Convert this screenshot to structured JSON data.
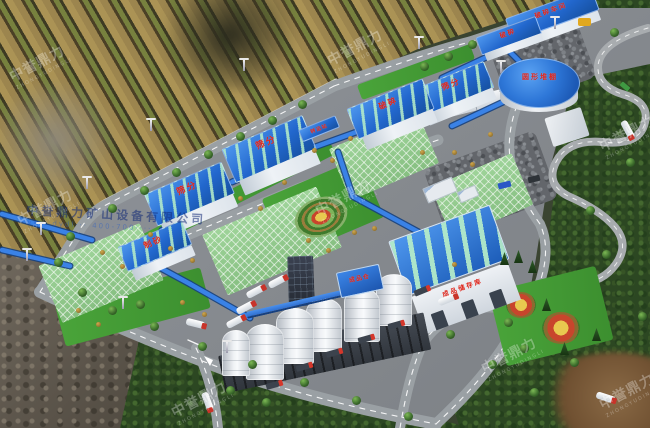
{
  "labels": {
    "crusher_station": "破碎车间",
    "crusher_top": "破碎",
    "screening_a": "筛分",
    "crusher_mid": "破碎",
    "screening_b": "筛分",
    "screening_c": "筛分",
    "sand_making": "制砂",
    "dome": "圆形堆棚",
    "transfer": "转运站",
    "warehouse_sign": "成品储存库",
    "silo_top_box": "成品仓"
  },
  "watermark": {
    "brand_cn": "中誉鼎力",
    "brand_en": "ZHONGYUDINGLI",
    "company_line": "中誉鼎力矿山设备有限公司",
    "contact_line": "www.dydl··· 400-700····"
  }
}
